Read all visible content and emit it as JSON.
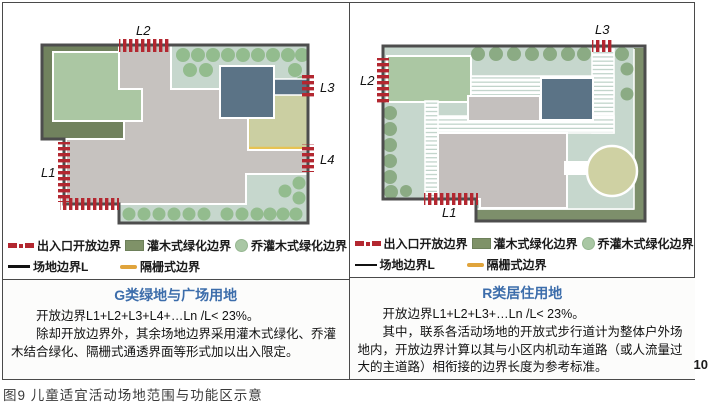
{
  "figure": {
    "caption": "图9 儿童适宜活动场地范围与功能区示意",
    "page_number": "10"
  },
  "legend": {
    "entrance_open_boundary": "出入口开放边界",
    "site_boundary": "场地边界L",
    "shrub_green_boundary": "灌木式绿化边界",
    "fence_boundary": "隔栅式边界",
    "tree_shrub_green_boundary": "乔灌木式绿化边界"
  },
  "panels": [
    {
      "title": "G类绿地与广场用地",
      "map_labels": {
        "L1": "L1",
        "L2": "L2",
        "L3": "L3",
        "L4": "L4"
      },
      "paragraphs": [
        "开放边界L1+L2+L3+L4+…Ln /L< 23%。",
        "除却开放边界外，其余场地边界采用灌木式绿化、乔灌木结合绿化、隔栅式通透界面等形式加以出入限定。"
      ]
    },
    {
      "title": "R类居住用地",
      "map_labels": {
        "L1": "L1",
        "L2": "L2",
        "L3": "L3"
      },
      "paragraphs": [
        "开放边界L1+L2+L3+…Ln /L< 23%。",
        "其中，联系各活动场地的开放式步行道计为整体户外场地内，开放边界计算以其与小区内机动车道路（或人流量过大的主道路）相衔接的边界长度为参考标准。"
      ]
    }
  ],
  "colors": {
    "title_blue": "#3c6dab",
    "marker_red": "#b32730",
    "site_background": "#c6d7cd",
    "dark_green_frame": "#71825e",
    "light_green_area": "#abc7a3",
    "tree_green": "#93bc8e",
    "plaza_gray": "#c6c2bf",
    "building_blue": "#5b7386",
    "fence_yellow": "#e7c352",
    "fenced_area": "#cbcfa2",
    "border_dark": "#4a4a4a"
  }
}
